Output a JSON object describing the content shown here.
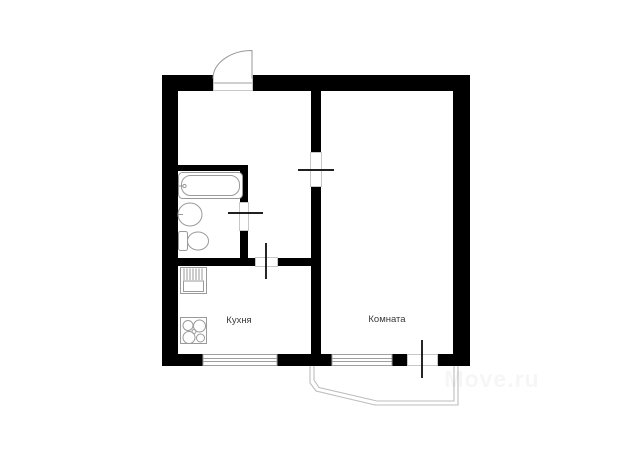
{
  "floorplan": {
    "labels": {
      "kitchen": "Кухня",
      "room": "Комната"
    },
    "watermark": "Move.ru",
    "elements": {
      "doors": [
        "entrance-door",
        "room-door",
        "bathroom-door",
        "kitchen-door",
        "balcony-door"
      ],
      "windows": [
        "kitchen-window",
        "room-window"
      ],
      "fixtures": [
        "bathtub",
        "washbasin",
        "toilet",
        "kitchen-sink",
        "stove"
      ],
      "outline": "balcony-outline"
    },
    "colors": {
      "wall": "#000000",
      "door_tick": "#000000",
      "fixture_outline": "#9a9a9a",
      "balcony_outline": "#bdbdbd",
      "label_text": "#3a3a3a",
      "background": "#ffffff"
    }
  }
}
